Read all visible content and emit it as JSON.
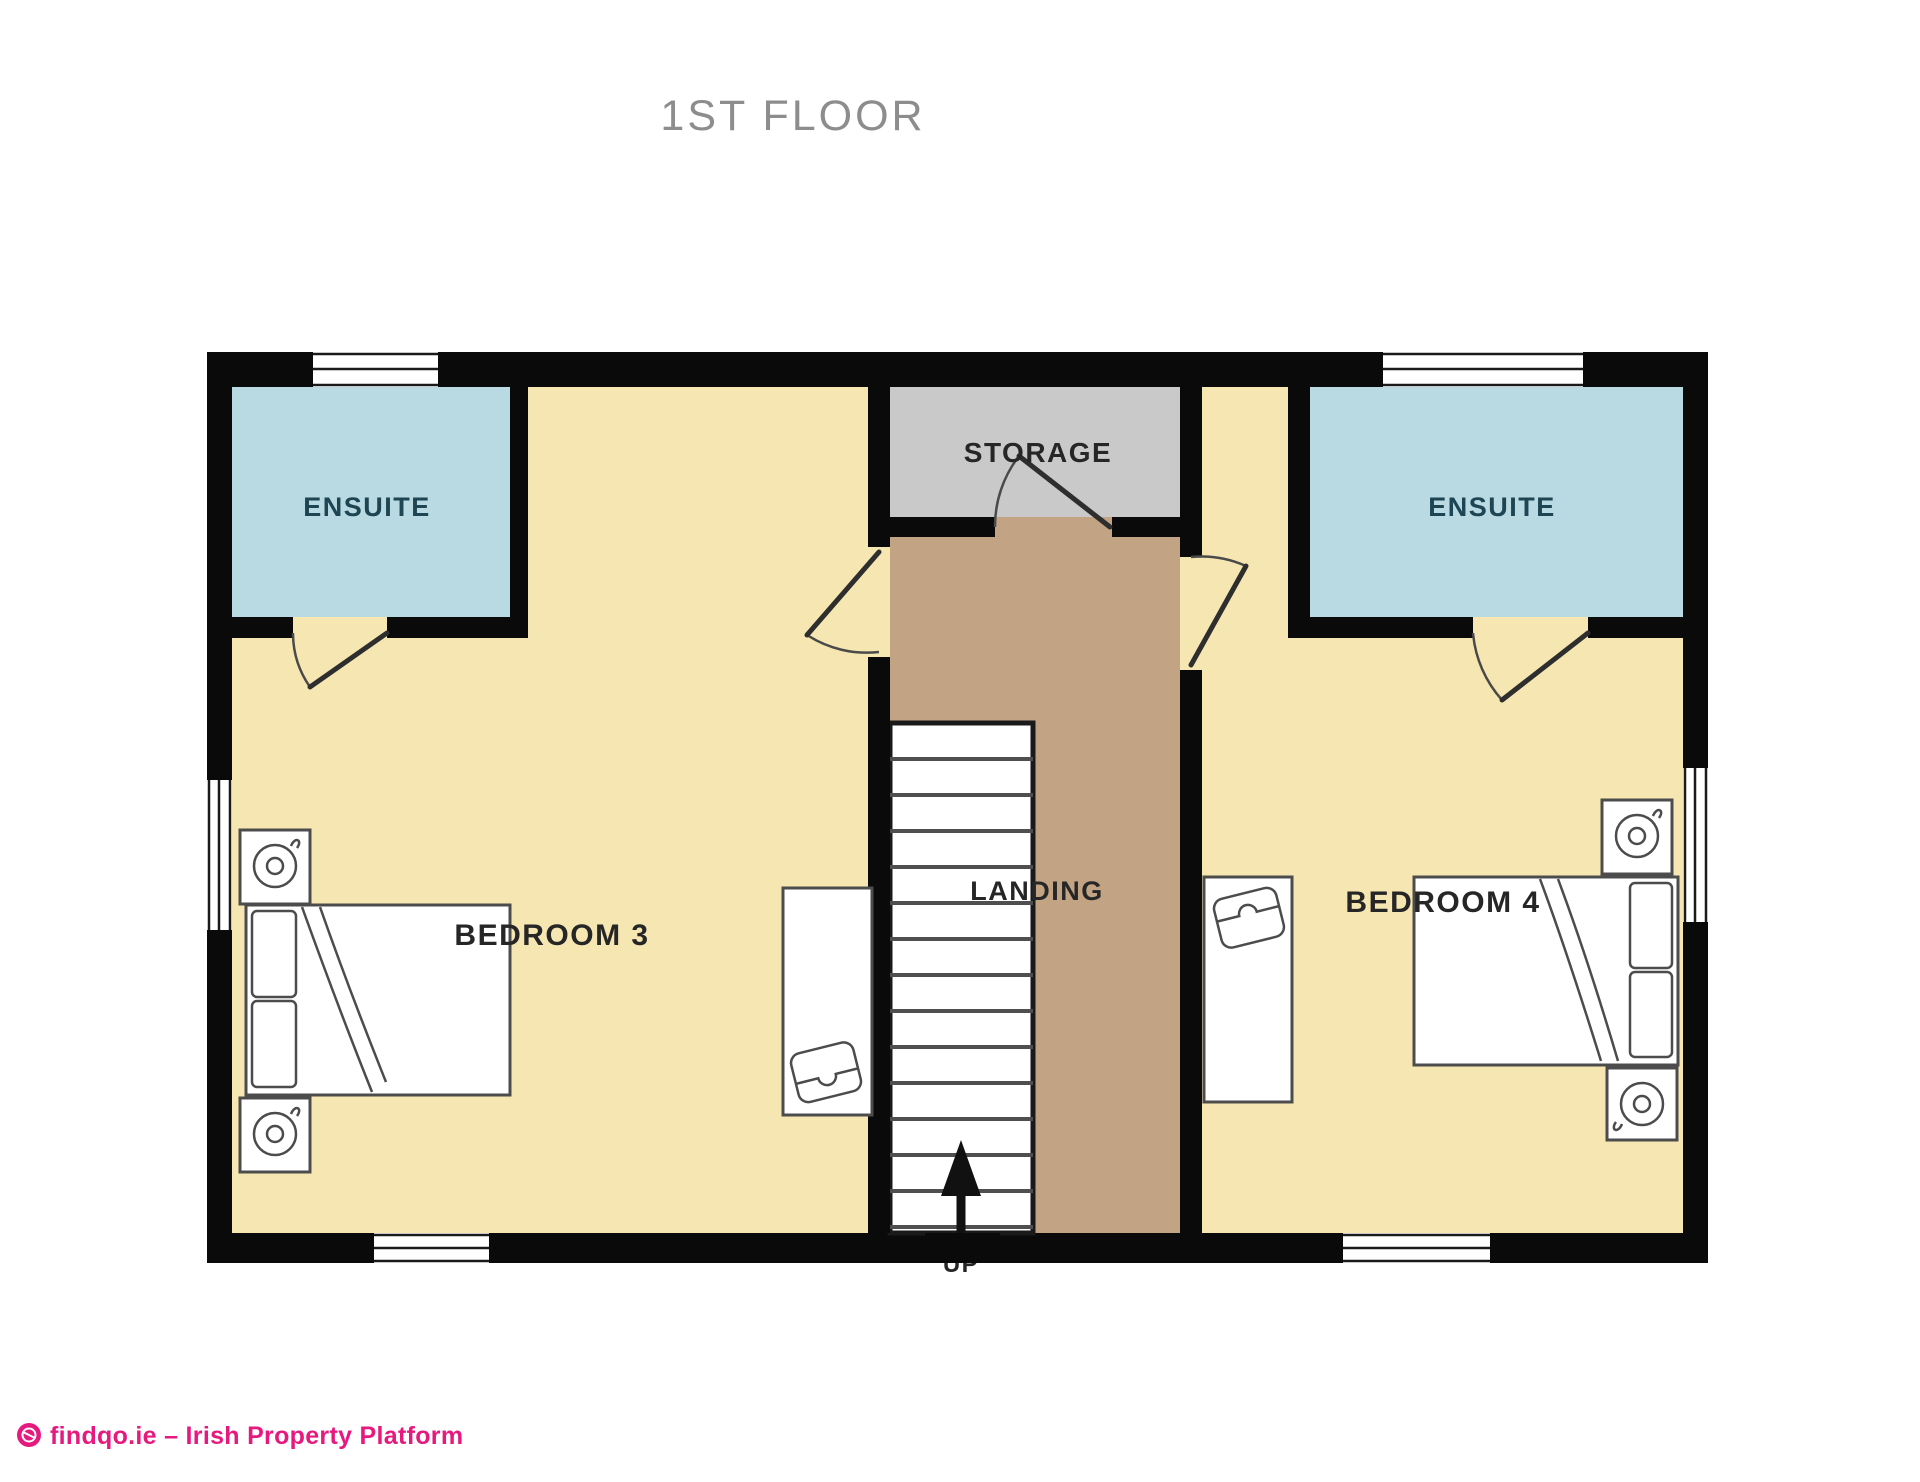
{
  "title": "1ST FLOOR",
  "rooms": {
    "ensuite_left": "ENSUITE",
    "ensuite_right": "ENSUITE",
    "storage": "STORAGE",
    "landing": "LANDING",
    "bedroom_3": "BEDROOM 3",
    "bedroom_4": "BEDROOM 4",
    "stairs_direction": "UP"
  },
  "footer": {
    "brand_text": "findqo.ie – Irish Property Platform"
  },
  "colors": {
    "floor_yellow": "#F6E7B2",
    "ensuite_blue": "#B9DAE2",
    "storage_gray": "#C9C9C9",
    "landing_tan": "#C2A384",
    "wall_black": "#0A0A0A",
    "title_gray": "#8D8D8D",
    "ensuite_label": "#1D4553",
    "label_dark": "#262626",
    "brand_pink": "#E6197E"
  }
}
